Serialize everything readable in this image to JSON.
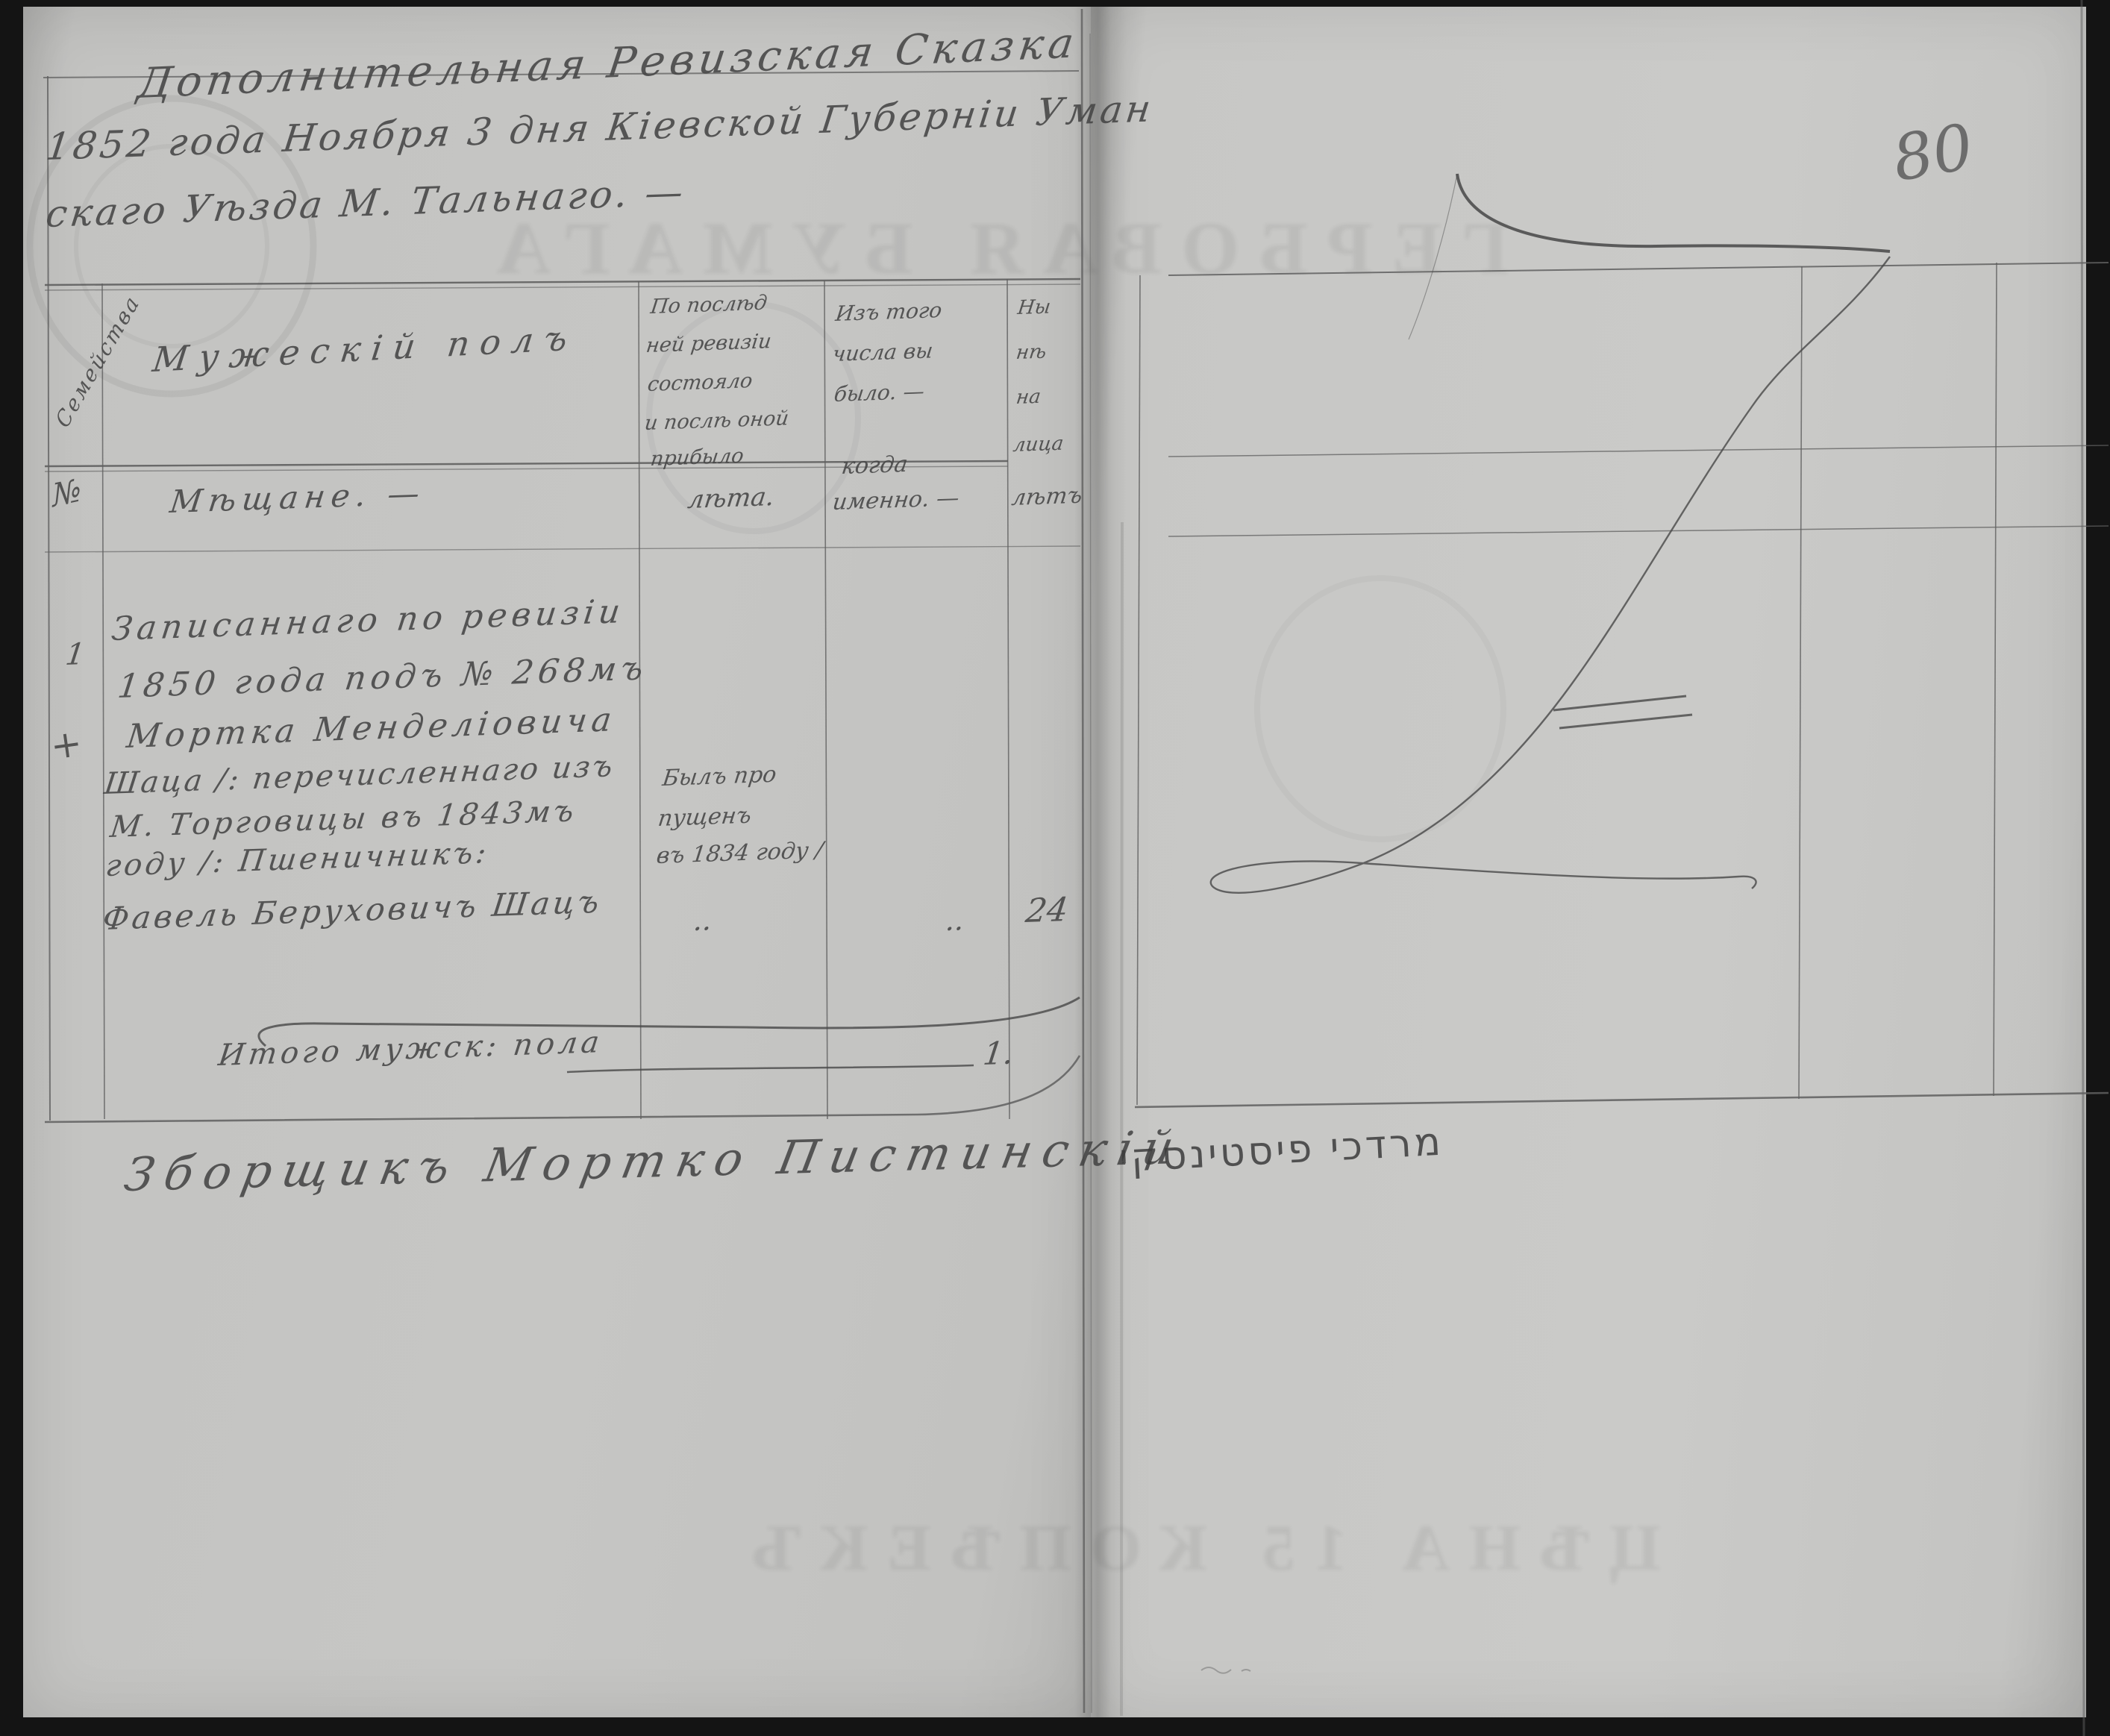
{
  "document": {
    "folio_number": "80",
    "title_lines": [
      "Дополнительная Ревизская Сказка",
      "1852 года Ноября 3 дня Кіевской Губерніи Уман",
      "скаго Уѣзда М. Тальнаго. —"
    ]
  },
  "table": {
    "header": {
      "family_col_rotated": "Семейства",
      "family_col_no": "№",
      "males_col": "Мужескій полъ",
      "males_col_sub": "Мѣщане. —",
      "prev_revision_col_lines": [
        "По послѣд",
        "ней ревизіи",
        "состояло",
        "и послѣ оной",
        "прибыло"
      ],
      "prev_revision_col_sub": "лѣта.",
      "departed_col_lines": [
        "Изъ того",
        "числа вы",
        "было. —"
      ],
      "departed_col_sub_lines": [
        "когда",
        "именно. —"
      ],
      "present_col_lines": [
        "Ны",
        "нѣ",
        "на",
        "лица"
      ],
      "present_col_sub": "лѣтъ"
    },
    "entry": {
      "row_number": "1",
      "check_mark": "+",
      "text_lines": [
        "Записаннаго по ревизіи",
        "1850 года подъ № 268мъ",
        "Мортка Менделіовича",
        "Шаца /: перечисленнаго изъ",
        "М. Торговицы въ 1843мъ",
        "году /: Пшеничникъ:",
        "Фавель Беруховичъ Шацъ"
      ],
      "note_lines": [
        "Былъ про",
        "пущенъ",
        "въ 1834 году /"
      ],
      "ditto_left": "..",
      "ditto_right": "..",
      "age": "24"
    },
    "total": {
      "label": "Итого мужск: пола",
      "value": "1."
    }
  },
  "signatures": {
    "russian": "Зборщикъ Мортко Пистинскій",
    "hebrew": "מרדכי פיסטינסקי"
  },
  "bleedthrough": {
    "top": "ГЕРБОВАЯ БУМАГА",
    "bottom": "ЦѢНА 15 КОПѢЕКЪ"
  },
  "colors": {
    "paper": "#c6c6c4",
    "ink": "#454545",
    "rule_line": "#5f5f5f",
    "scan_background": "#161616"
  }
}
